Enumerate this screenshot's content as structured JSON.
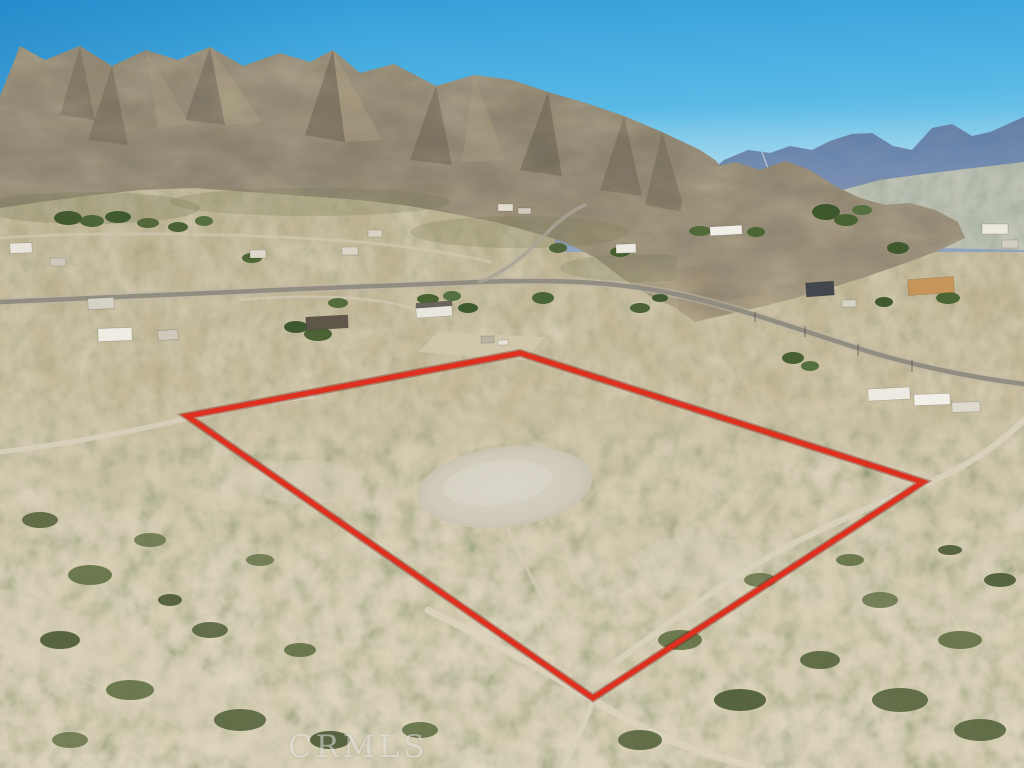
{
  "scene": {
    "type": "aerial-drone-photo",
    "subject": "Vacant desert land parcel outlined in red, desert valley homes and rocky mountain ridge behind",
    "watermark": "CRMLS"
  },
  "boundary": {
    "points": "187,416 520,353 923,482 593,698",
    "color": "#df2f1e"
  },
  "palette": {
    "sky_top": "#2f9ad7",
    "sky_horizon": "#daeef3",
    "far_mountains": "#5b7cab",
    "ridge_rock": "#85795f",
    "valley_floor": "#c3b492",
    "foreground_sand": "#d4c9ad",
    "shrub_green": "#55633a",
    "paved_road": "#8f8a80",
    "dirt_road": "#dbd3bd",
    "cleared_pad": "#cfcaba",
    "watermark_color": "rgba(255,255,255,0.46)"
  }
}
